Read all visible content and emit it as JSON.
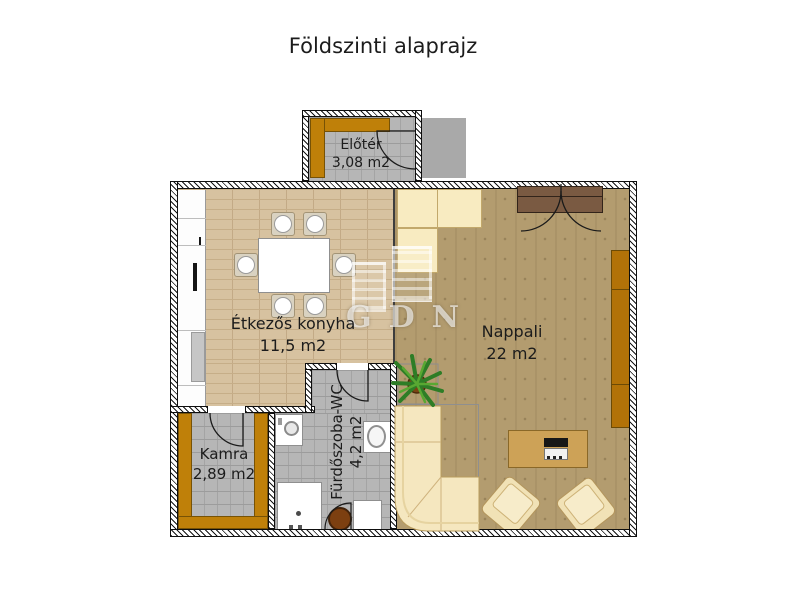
{
  "title": "Földszinti alaprajz",
  "rooms": {
    "eloter": {
      "name": "Előtér",
      "area": "3,08 m2"
    },
    "konyha": {
      "name": "Étkezős konyha",
      "area": "11,5 m2"
    },
    "nappali": {
      "name": "Nappali",
      "area": "22 m2"
    },
    "kamra": {
      "name": "Kamra",
      "area": "2,89 m2"
    },
    "furdo": {
      "name": "Fürdőszoba-WC",
      "area": "4,2 m2"
    }
  },
  "watermark": {
    "text": "GDN"
  },
  "colors": {
    "wall_line": "#161616",
    "orange_furniture": "#bf8009",
    "kitchen_floor": "#d7c2a0",
    "living_floor": "#b39c6f",
    "tile_floor": "#b6b6b6",
    "cream_furniture": "#f5e7bf",
    "coffee_table": "#cda257",
    "door_panel_brown": "#7a5a42",
    "porch_gray": "#a9a9a9"
  }
}
